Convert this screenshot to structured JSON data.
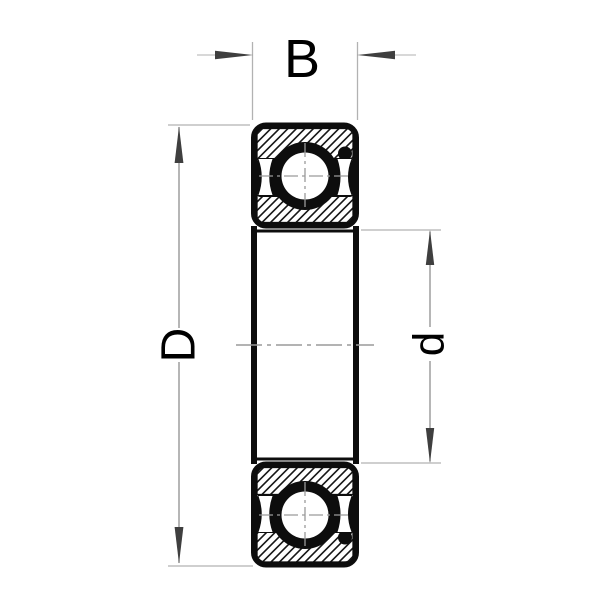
{
  "figure": {
    "type": "ball-bearing-cross-section-drawing",
    "labels": {
      "width": "B",
      "outer_diameter": "D",
      "bore_diameter": "d"
    },
    "colors": {
      "background": "#ffffff",
      "ink": "#0d0d0d",
      "hatch": "#161616",
      "dimension_line": "#8f8f8f",
      "extension_line": "#b2b2b2",
      "leader_line": "#c0c0c0",
      "arrow": "#3f3f3f",
      "centerline": "#9a9a9a",
      "label_text": "#000000"
    }
  }
}
